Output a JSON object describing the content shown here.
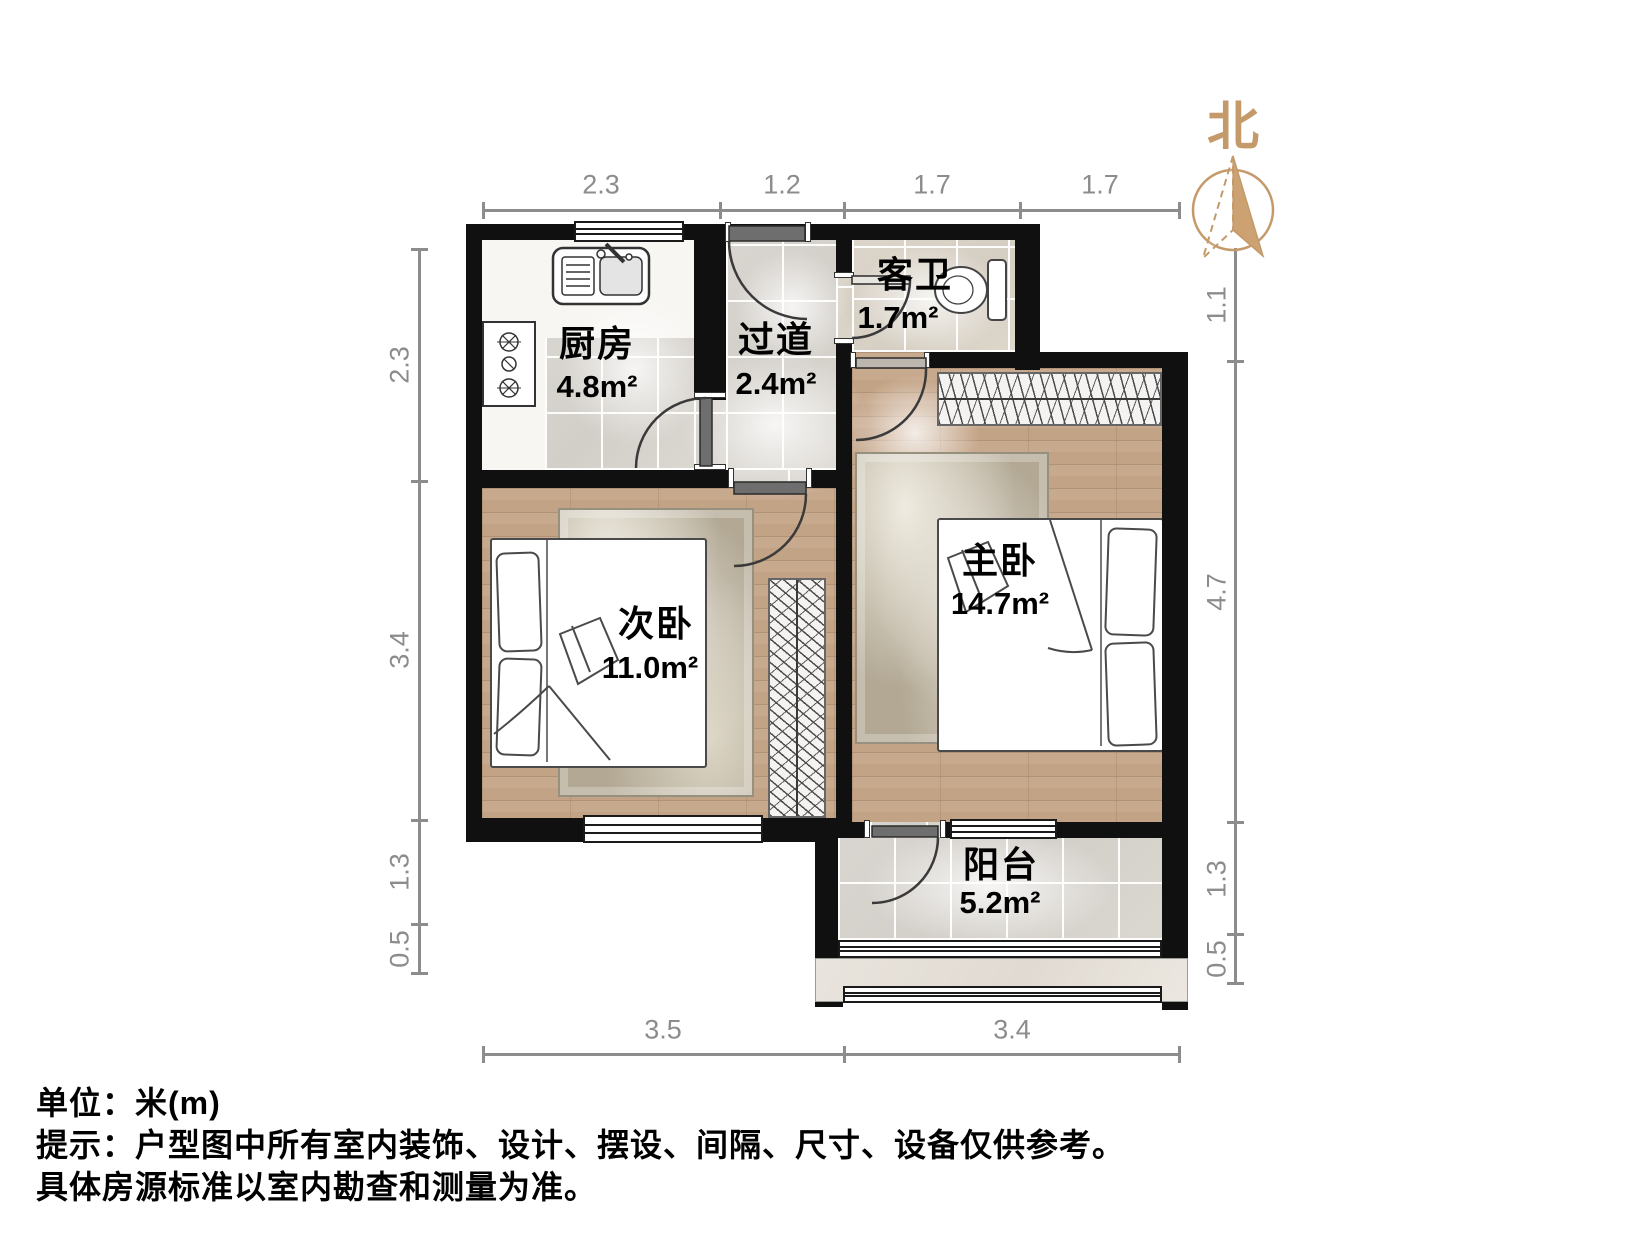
{
  "north_label": "北",
  "rooms": {
    "kitchen": {
      "name": "厨房",
      "area": "4.8m²"
    },
    "hallway": {
      "name": "过道",
      "area": "2.4m²"
    },
    "guest_bath": {
      "name": "客卫",
      "area": "1.7m²"
    },
    "master_bedroom": {
      "name": "主卧",
      "area": "14.7m²"
    },
    "second_bedroom": {
      "name": "次卧",
      "area": "11.0m²"
    },
    "balcony": {
      "name": "阳台",
      "area": "5.2m²"
    }
  },
  "dimensions": {
    "top": [
      "2.3",
      "1.2",
      "1.7",
      "1.7"
    ],
    "bottom": [
      "3.5",
      "3.4"
    ],
    "left": [
      "2.3",
      "3.4",
      "1.3",
      "0.5"
    ],
    "right": [
      "1.1",
      "4.7",
      "1.3",
      "0.5"
    ]
  },
  "footer": {
    "unit": "单位：米(m)",
    "hint1": "提示：户型图中所有室内装饰、设计、摆设、间隔、尺寸、设备仅供参考。",
    "hint2": "具体房源标准以室内勘查和测量为准。"
  },
  "colors": {
    "wall": "#101010",
    "wood_floor": "#c3a385",
    "tile_floor": "#d6d2cc",
    "compass": "#c49a6b",
    "dimension": "#8c8c8c"
  }
}
